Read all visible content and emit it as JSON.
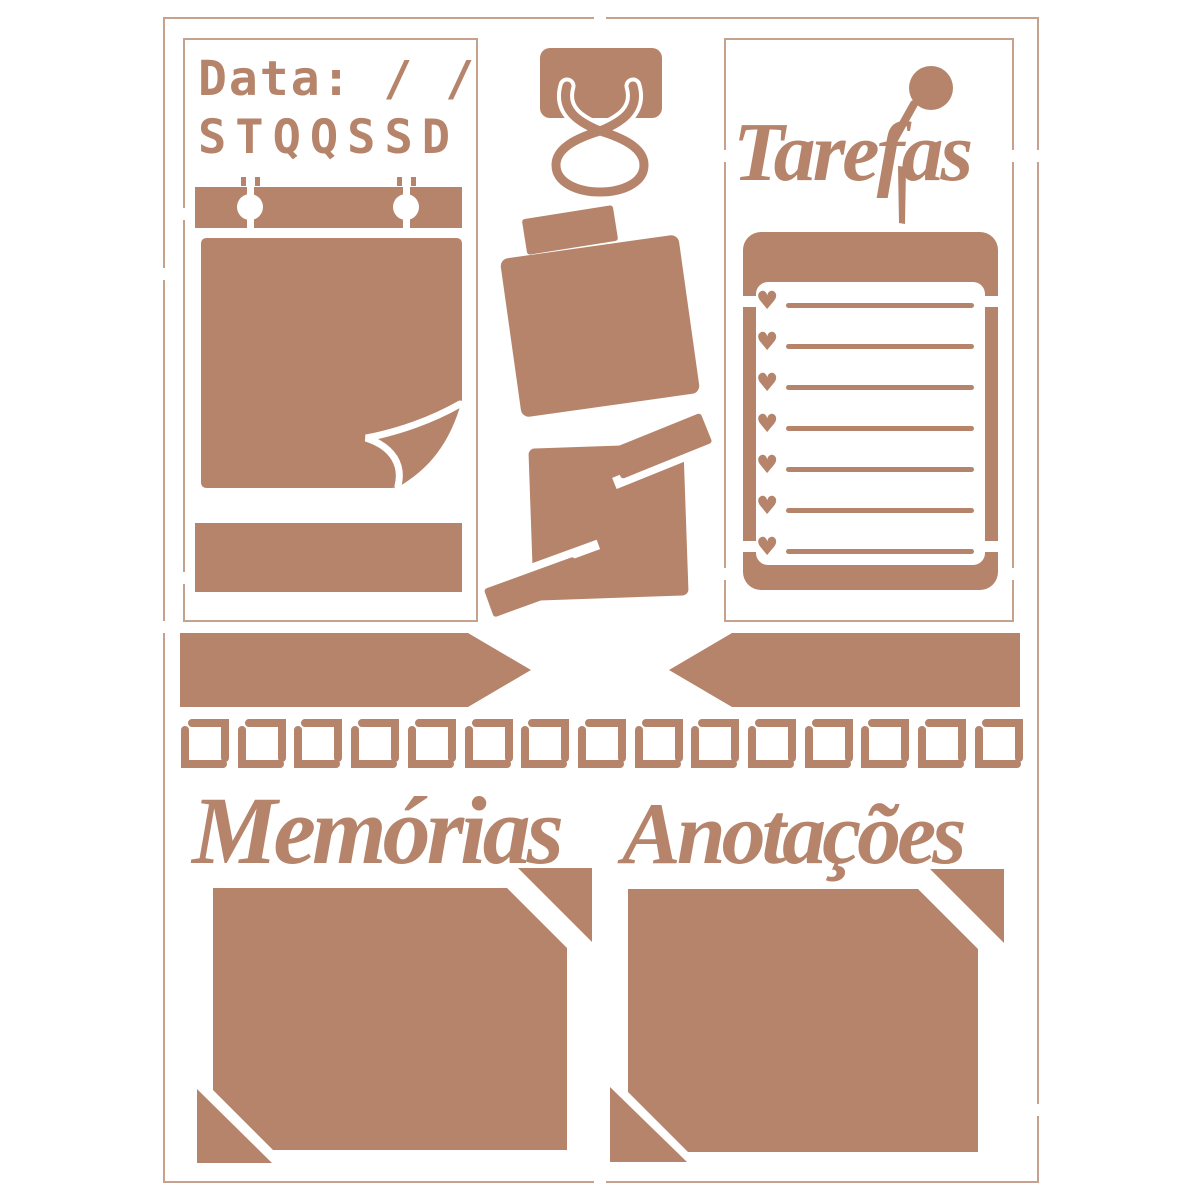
{
  "colors": {
    "stencil": "#b5846b",
    "outline": "#c6a28c",
    "background": "#ffffff"
  },
  "date_panel": {
    "date_label": "Data: / /",
    "weekday_initials": "STQQSSD"
  },
  "tasks_panel": {
    "title": "Tarefas",
    "checklist_rows": 7,
    "heart_glyph": "♥"
  },
  "divider": {
    "border_squares": 15
  },
  "memories_section": {
    "title": "Memórias"
  },
  "notes_section": {
    "title": "Anotações"
  }
}
